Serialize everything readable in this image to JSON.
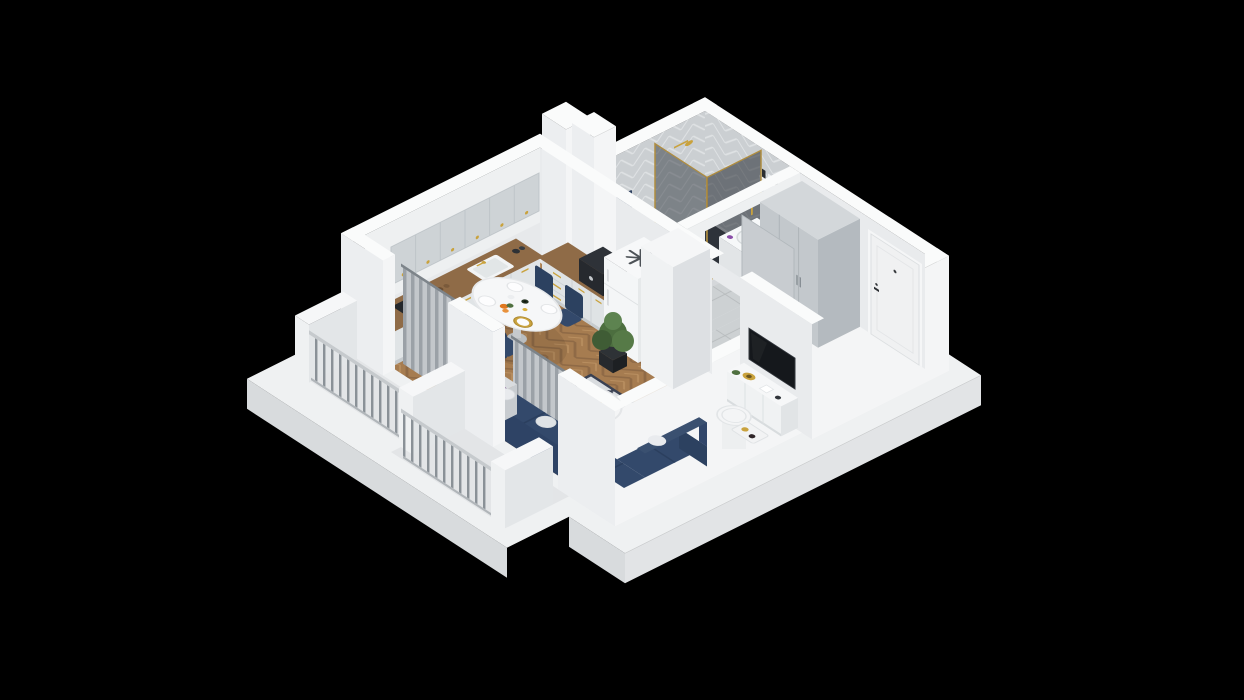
{
  "scene": {
    "title": "3D isometric cutaway floor plan of a studio apartment on a black background",
    "style": "axonometric render, white section-cut walls, no visible text",
    "background": "#000000",
    "colors": {
      "background": "#000000",
      "wall_top": "#fafbfb",
      "wall_outer_light": "#f4f5f6",
      "wall_outer_shade": "#eceef0",
      "wall_inner_light": "#eef0f1",
      "wall_inner_shade": "#e9ebed",
      "floor_wood": "#a67c50",
      "floor_tile": "#cdd1d3",
      "counter_wood": "#8f6b47",
      "cabinet_gray": "#ced3d6",
      "wardrobe_gray": "#c3c8cc",
      "sofa_navy": "#33496b",
      "sofa_navy_dark": "#2c4160",
      "rug_base": "#d9dcdf",
      "rug_pattern": "#3a4152",
      "curtain_gray": "#aab0b5",
      "railing_gray": "#8a9197",
      "gold": "#c9a23d",
      "shower_glass": "#20262e",
      "tv_black": "#15181c",
      "plant_green": "#4c6e3f",
      "accent_purple": "#7b3f98"
    },
    "rooms": [
      {
        "name": "kitchen",
        "furniture": [
          "upper cabinets with gold knobs",
          "L-shaped counter with wood top",
          "sink with gold faucet",
          "black cooktop",
          "fridge with snowflake symbol on top",
          "coffee machine"
        ]
      },
      {
        "name": "bathroom",
        "furniture": [
          "gray herringbone tiled walls",
          "corner shower with smoked glass and gold frame",
          "gold shower head",
          "navy towel",
          "white vanity with basin and gold faucet",
          "wall shelves with towels and bottles",
          "gray door open to hallway"
        ]
      },
      {
        "name": "hallway",
        "furniture": [
          "gray three-door wardrobe",
          "white entrance door with dark handle",
          "gray tile floor"
        ]
      },
      {
        "name": "living-room",
        "furniture": [
          "navy corner sofa with round white pillows",
          "diamond pattern rug",
          "round white coffee table with purple vase",
          "white TV sideboard with gold dish",
          "wall-mounted black TV",
          "oval white dining table with four navy chairs",
          "tall white cabinet",
          "floor plant",
          "gray curtains at balcony doors",
          "white side table and decor tray"
        ]
      },
      {
        "name": "balcony",
        "furniture": [
          "metal bar railings",
          "white divider piers",
          "concrete slab floor"
        ]
      }
    ]
  }
}
